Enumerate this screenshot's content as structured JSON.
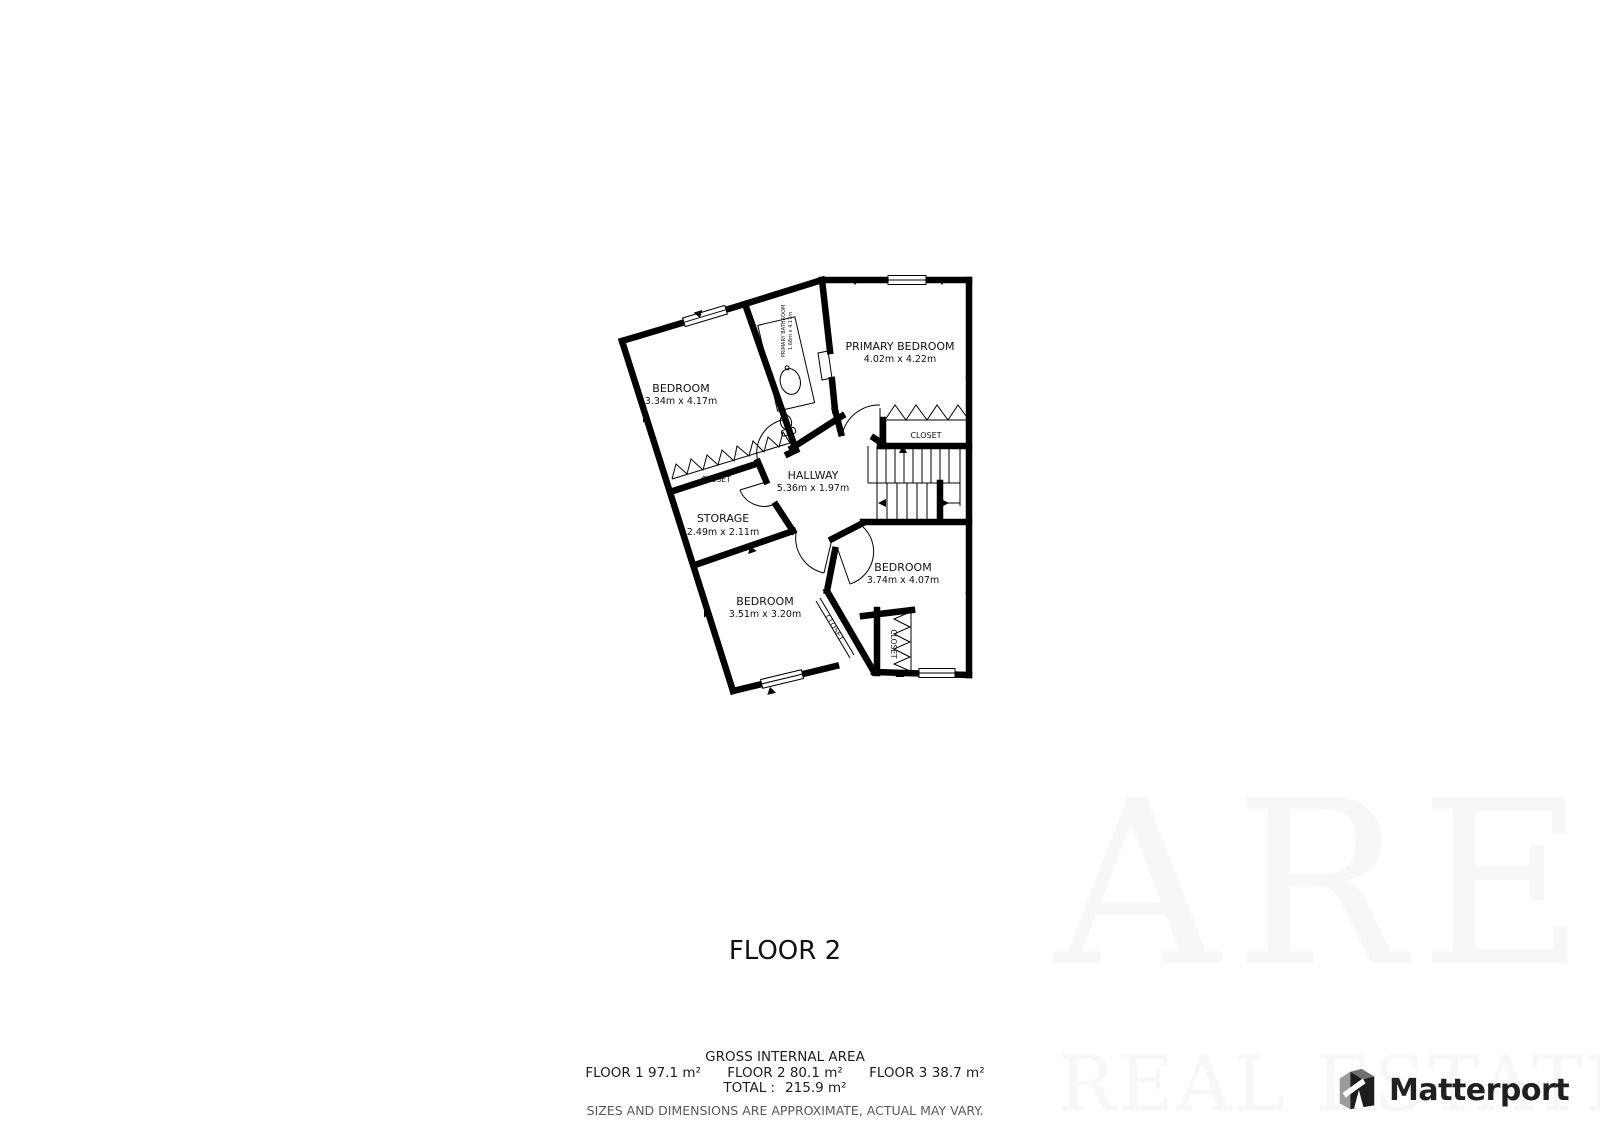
{
  "plan": {
    "rooms": [
      {
        "name": "BEDROOM",
        "dims": "3.34m x 4.17m"
      },
      {
        "name": "PRIMARY BATHROOM",
        "dims": "1.68m x 4.17m"
      },
      {
        "name": "PRIMARY BEDROOM",
        "dims": "4.02m x 4.22m"
      },
      {
        "name": "HALLWAY",
        "dims": "5.36m x 1.97m"
      },
      {
        "name": "STORAGE",
        "dims": "2.49m x 2.11m"
      },
      {
        "name": "BEDROOM",
        "dims": "3.51m x 3.20m"
      },
      {
        "name": "BEDROOM",
        "dims": "3.74m x 4.07m"
      }
    ],
    "closets": [
      "CLOSET",
      "CLOSET",
      "CLOSET",
      "CLOSET"
    ]
  },
  "title": {
    "floor_label": "FLOOR 2"
  },
  "footer": {
    "gross_title": "GROSS INTERNAL AREA",
    "floors": [
      {
        "label": "FLOOR 1",
        "area": "97.1 m²"
      },
      {
        "label": "FLOOR 2",
        "area": "80.1 m²"
      },
      {
        "label": "FLOOR 3",
        "area": "38.7 m²"
      }
    ],
    "total_label": "TOTAL :",
    "total_area": "215.9 m²",
    "disclaimer": "SIZES AND DIMENSIONS ARE APPROXIMATE, ACTUAL MAY VARY."
  },
  "branding": {
    "name": "Matterport"
  },
  "watermark": {
    "line1": "ARE",
    "line2": "REAL ESTATE"
  },
  "colors": {
    "wall": "#000000",
    "background": "#ffffff",
    "text": "#111111",
    "disclaimer_text": "#595959",
    "brand_text": "#202020",
    "watermark": "#f7f7f7"
  }
}
